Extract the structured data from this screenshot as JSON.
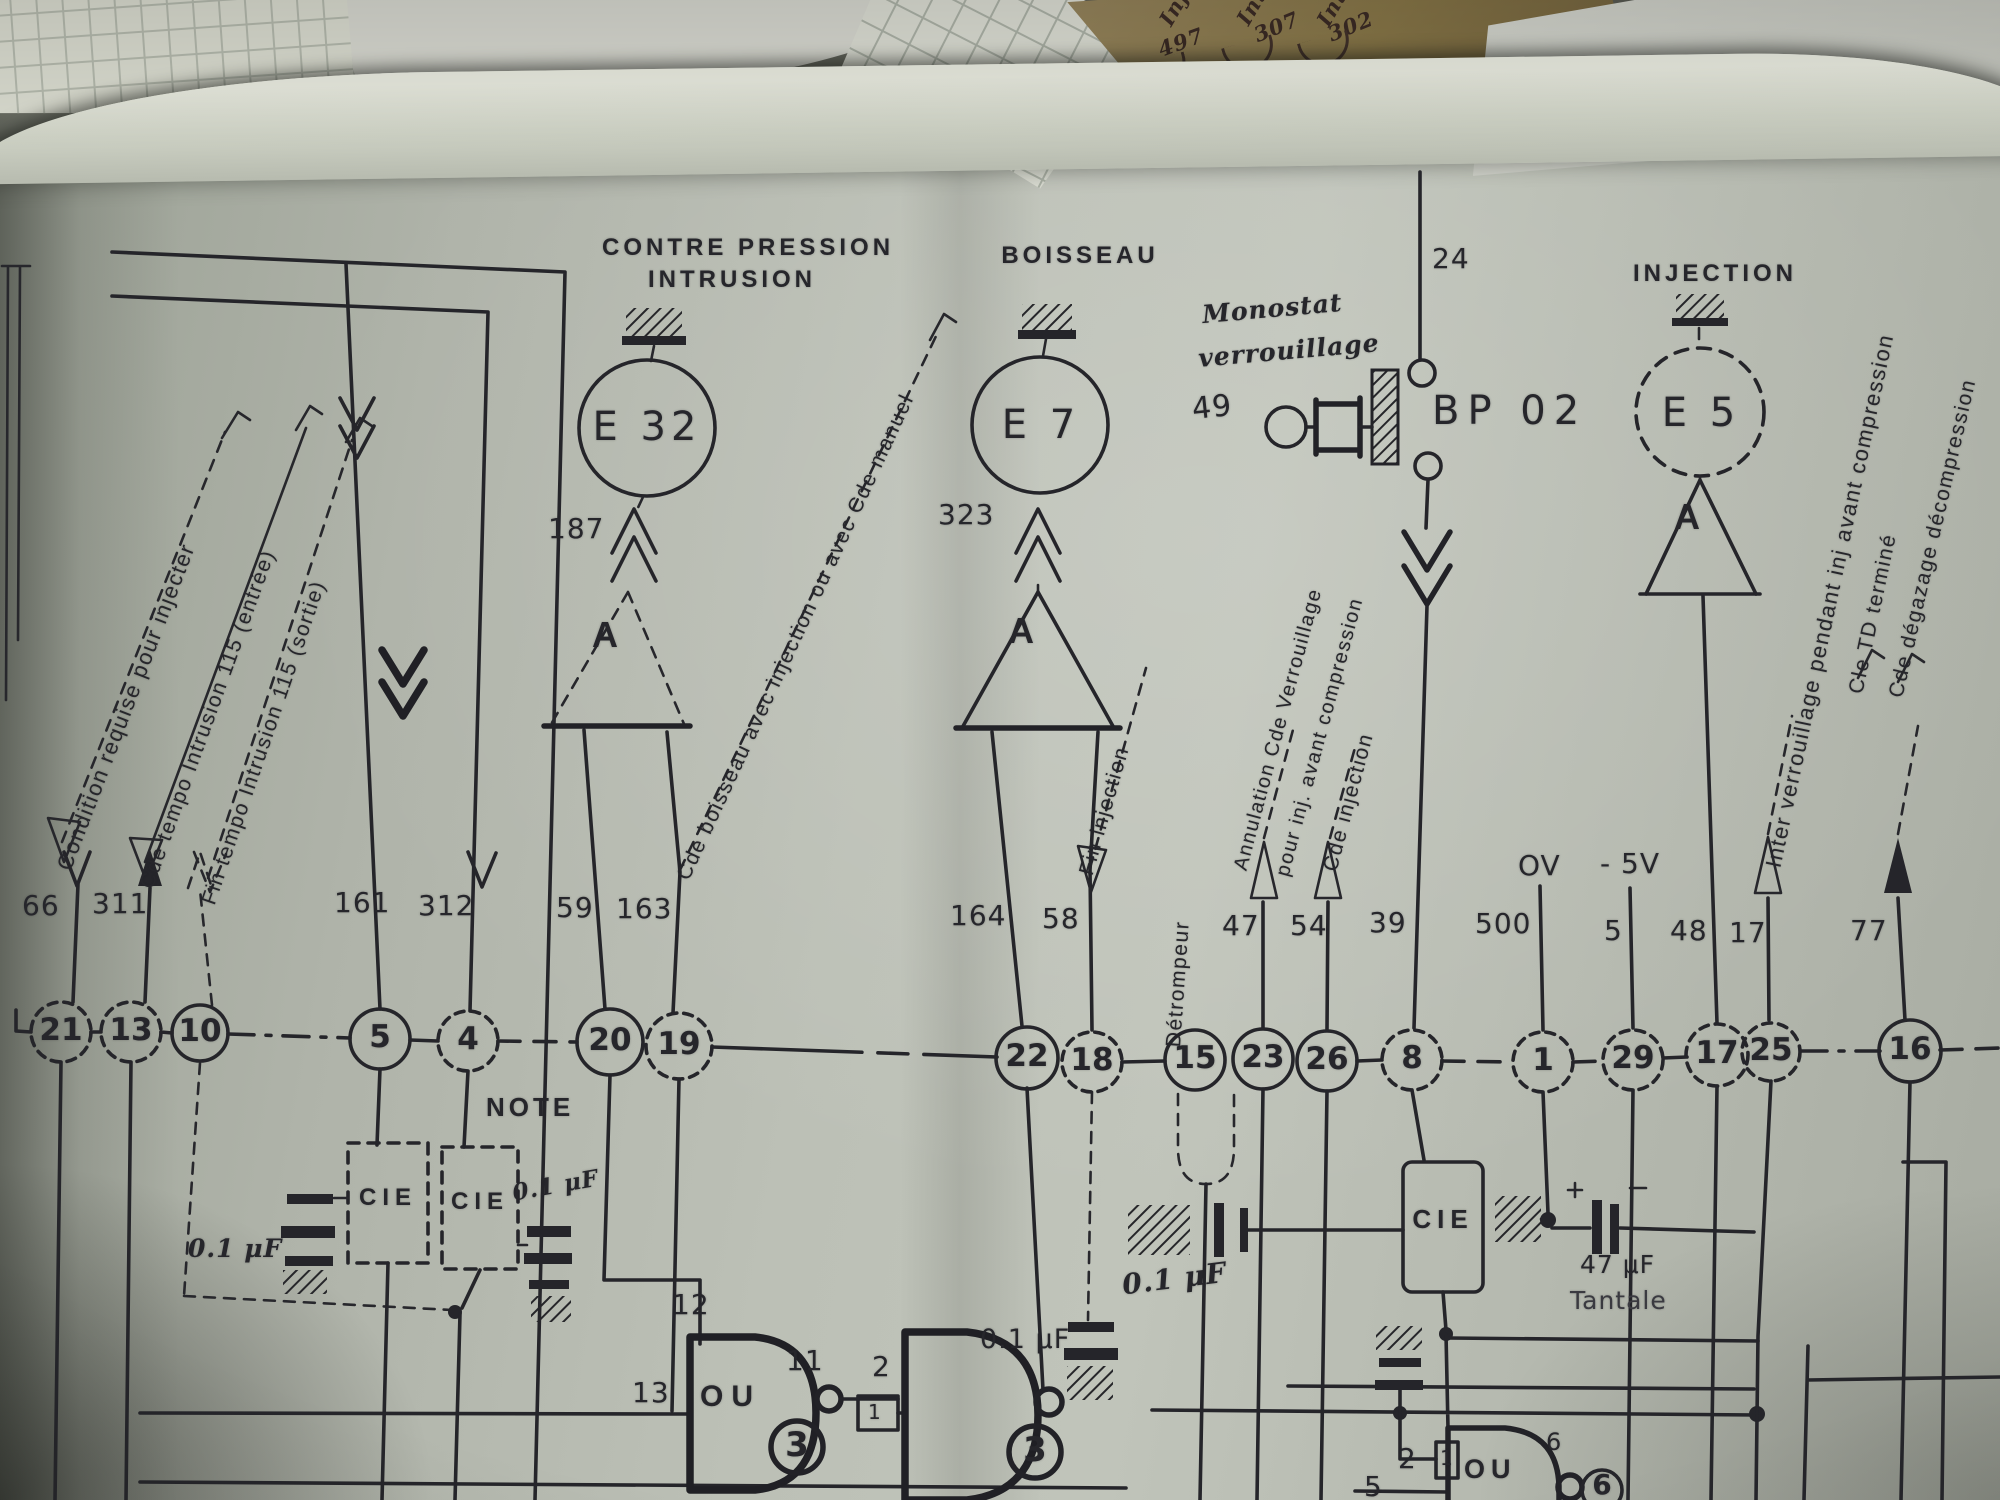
{
  "scraps": {
    "labels": [
      "Inje",
      "497",
      "Inter",
      "307",
      "Inter",
      "302"
    ]
  },
  "titles": {
    "contre_pression": "CONTRE PRESSION",
    "intrusion": "INTRUSION",
    "boisseau": "BOISSEAU",
    "injection": "INJECTION",
    "monostat": "Monostat",
    "verrouillage": "verrouillage",
    "bp02": "BP 02",
    "note": "NOTE"
  },
  "components": {
    "e32": "E 32",
    "e7": "E 7",
    "e5": "E 5",
    "amp": "A",
    "cie": "CIE"
  },
  "wires": {
    "w24": "24",
    "w187": "187",
    "w323": "323",
    "w49": "49",
    "w66": "66",
    "w311": "311",
    "w161": "161",
    "w312": "312",
    "w59": "59",
    "w163": "163",
    "w164": "164",
    "w58": "58",
    "w47": "47",
    "w54": "54",
    "w39": "39",
    "w500": "500",
    "w5": "5",
    "w48": "48",
    "w17": "17",
    "w77": "77",
    "ov": "OV",
    "neg5v": "- 5V"
  },
  "terminals": [
    "21",
    "13",
    "10",
    "5",
    "4",
    "20",
    "19",
    "22",
    "18",
    "15",
    "23",
    "26",
    "8",
    "1",
    "29",
    "17",
    "25",
    "16"
  ],
  "gates": {
    "g1_label": "OU",
    "g1_in_top": "12",
    "g1_in_left": "13",
    "g1_out": "11",
    "g1_tag": "3",
    "g2_in_top": "2",
    "g2_in_box": "1",
    "g2_tag": "3",
    "g3_label": "OU",
    "g3_in_a": "2",
    "g3_in_box": "1",
    "g3_in_c": "5",
    "g3_out": "6",
    "g3_tag": "6"
  },
  "capacitors": {
    "c1": "0.1 μF",
    "c2": "0.1 μF",
    "c3": "0.1 μF",
    "c4": "0.1 μF",
    "c47": "47 μF",
    "c47_type": "Tantale"
  },
  "annotations": {
    "condition": "Condition requise pour injecter",
    "tempo_entree": "Cde tempo Intrusion 115 (entrée)",
    "tempo_sortie": "Fin tempo Intrusion 115 (sortie)",
    "boisseau_cmd": "Cde boisseau avec injection ou avec Cde manuel",
    "fin_injection": "Fin injection",
    "detrompeur": "Détrompeur",
    "annulation_1": "Annulation Cde Verrouillage",
    "annulation_2": "pour inj. avant compression",
    "c_injection": "Cde injection",
    "inter_verrouillage": "Inter verrouillage pendant inj avant compression",
    "c_td": "Cle TD terminé",
    "degazage": "Cde dégazage décompression"
  }
}
